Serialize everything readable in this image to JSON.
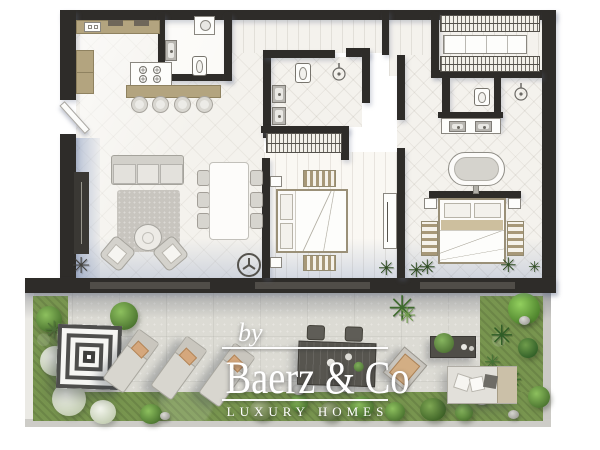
{
  "watermark": {
    "prefix": "by",
    "brand": "Baerz & Co",
    "tagline": "LUXURY HOMES"
  },
  "glyphs": {
    "plant": "✳"
  },
  "palette": {
    "wall": "#2e2c29",
    "wood": "#b3a47f",
    "floor": "#f4f2ed",
    "floor_light": "#faf8f3",
    "terrace_stone": "#dcdbd4",
    "grass": "#78954f",
    "shadow_blue": "#9dafd0",
    "furniture_gray": "#d9d7d1",
    "outdoor_dark": "#57554f",
    "cushion_tan": "#d5a77c",
    "watermark_white": "#ffffff"
  },
  "plan": {
    "type": "apartment-floor-plan-render",
    "rooms": [
      {
        "name": "kitchen",
        "furniture": [
          "counter",
          "tall-cabinets",
          "island-stove",
          "breakfast-bar",
          "bar-stools"
        ]
      },
      {
        "name": "utility-bathroom",
        "furniture": [
          "washing-machine",
          "washbasin",
          "toilet"
        ]
      },
      {
        "name": "living-dining-room",
        "furniture": [
          "tv-sideboard",
          "sofa",
          "rug",
          "coffee-table",
          "armchairs",
          "dining-table",
          "dining-chairs",
          "ceiling-fan",
          "plant"
        ]
      },
      {
        "name": "bedroom-1",
        "furniture": [
          "double-bed",
          "nightstands",
          "striped-benches",
          "tv-console",
          "wardrobe",
          "plants"
        ]
      },
      {
        "name": "ensuite-bathroom-1",
        "furniture": [
          "toilet",
          "shower",
          "double-washbasin"
        ]
      },
      {
        "name": "master-bathroom",
        "furniture": [
          "toilet",
          "shower",
          "double-vanity"
        ]
      },
      {
        "name": "walk-in-closet",
        "furniture": [
          "hanging-rail",
          "island-dresser",
          "hanging-rail"
        ]
      },
      {
        "name": "master-bedroom",
        "furniture": [
          "freestanding-bathtub",
          "double-bed",
          "nightstands",
          "striped-rugs",
          "plants"
        ]
      }
    ],
    "terrace_items": [
      "square-striped-parasol",
      "sun-lounger",
      "sun-lounger",
      "sun-lounger",
      "outdoor-dining-set",
      "outdoor-lounge-chair",
      "outdoor-coffee-table",
      "outdoor-sofa",
      "planting-beds",
      "bushes",
      "rocks"
    ]
  }
}
